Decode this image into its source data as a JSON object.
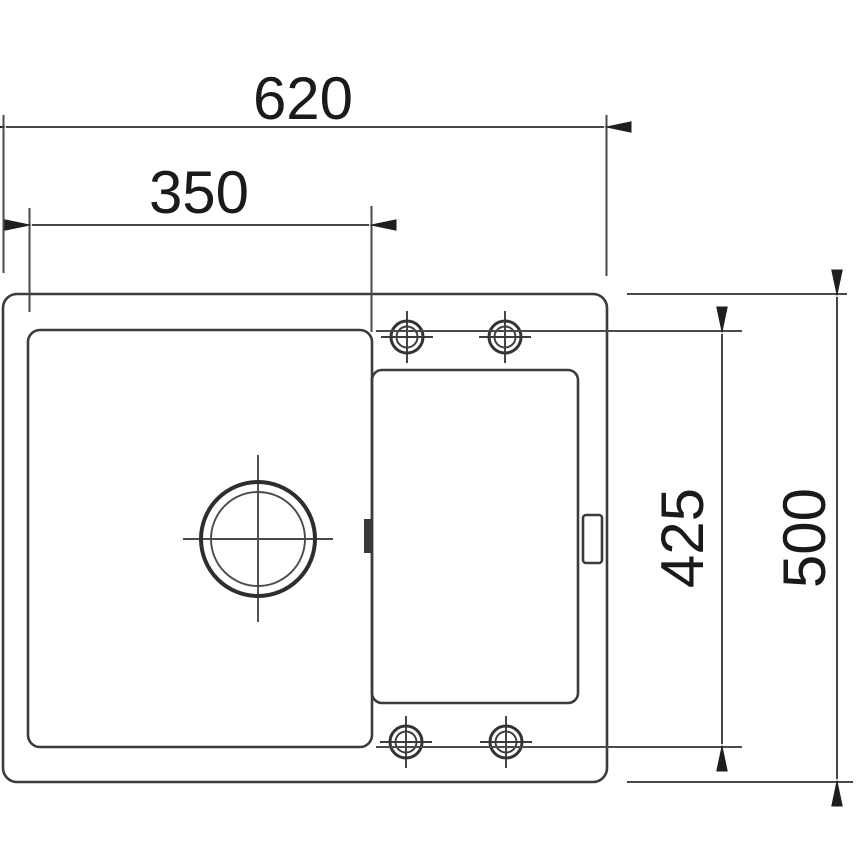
{
  "drawing": {
    "dimensions": {
      "overall_width": "620",
      "bowl_width": "350",
      "inner_height": "425",
      "overall_height": "500"
    },
    "colors": {
      "line": "#3c3c3c",
      "dimension_line": "#464646",
      "text": "#1a1a1a",
      "background": "#ffffff"
    }
  }
}
